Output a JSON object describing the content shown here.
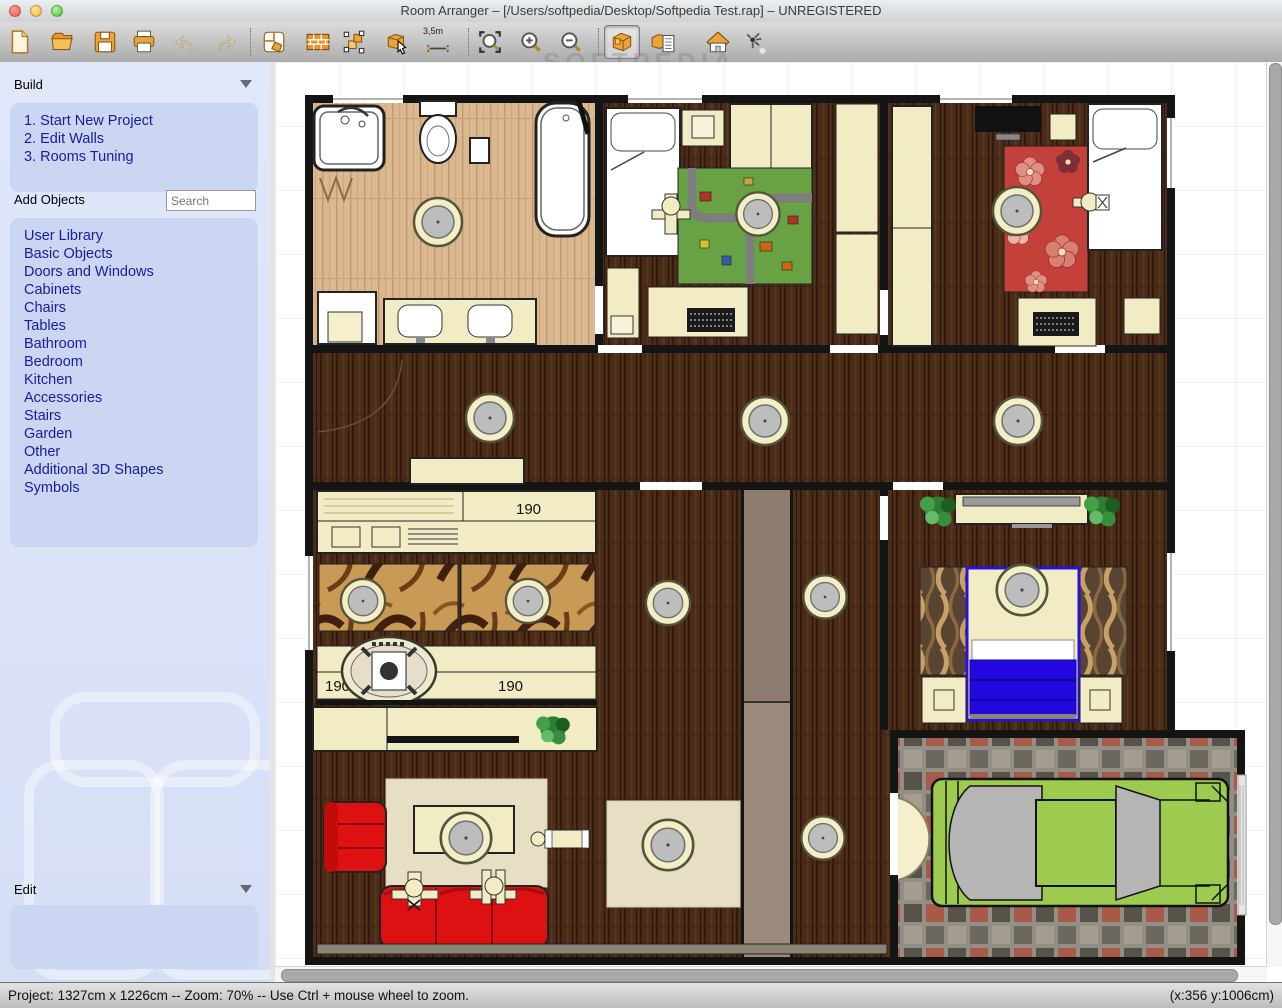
{
  "window": {
    "title": "Room Arranger – [/Users/softpedia/Desktop/Softpedia Test.rap] – UNREGISTERED"
  },
  "toolbar": {
    "measure_label": "3,5m",
    "buttons": [
      "new",
      "open",
      "save",
      "print",
      "undo",
      "redo",
      "edit-rooms",
      "edit-walls",
      "select-objects",
      "insert-object",
      "measure",
      "zoom-to-fit",
      "zoom-in",
      "zoom-out",
      "objects",
      "object-properties",
      "view-3d",
      "light-settings"
    ],
    "selected_button": "objects"
  },
  "watermark": {
    "brand": "SOFTPEDIA",
    "site": "www.softpedia.com"
  },
  "sidebar": {
    "build": {
      "title": "Build",
      "steps": [
        "1. Start New Project",
        "2. Edit Walls",
        "3. Rooms Tuning"
      ]
    },
    "add_objects": {
      "label": "Add Objects",
      "search_placeholder": "Search",
      "categories": [
        "User Library",
        "Basic Objects",
        "Doors and Windows",
        "Cabinets",
        "Chairs",
        "Tables",
        "Bathroom",
        "Bedroom",
        "Kitchen",
        "Accessories",
        "Stairs",
        "Garden",
        "Other",
        "Additional 3D Shapes",
        "Symbols"
      ]
    },
    "edit": {
      "title": "Edit"
    }
  },
  "plan": {
    "labels": {
      "counter": "190",
      "table_left": "190",
      "table_right": "190"
    }
  },
  "statusbar": {
    "left": "Project: 1327cm x 1226cm -- Zoom: 70% -- Use Ctrl + mouse wheel to zoom.",
    "right": "(x:356 y:1006cm)"
  },
  "colors": {
    "link_blue": "#1b1b9e",
    "sidebar_bg": "#dce3f8",
    "panel_bg": "#cbd6f3",
    "wall": "#141414",
    "dark_floor": "#4a2c19",
    "light_floor": "#d9b58d",
    "furniture_cream": "#f2ecc4",
    "sofa_red": "#dd1111",
    "bed_blue": "#2408e0",
    "car_green": "#9ccb4f"
  }
}
